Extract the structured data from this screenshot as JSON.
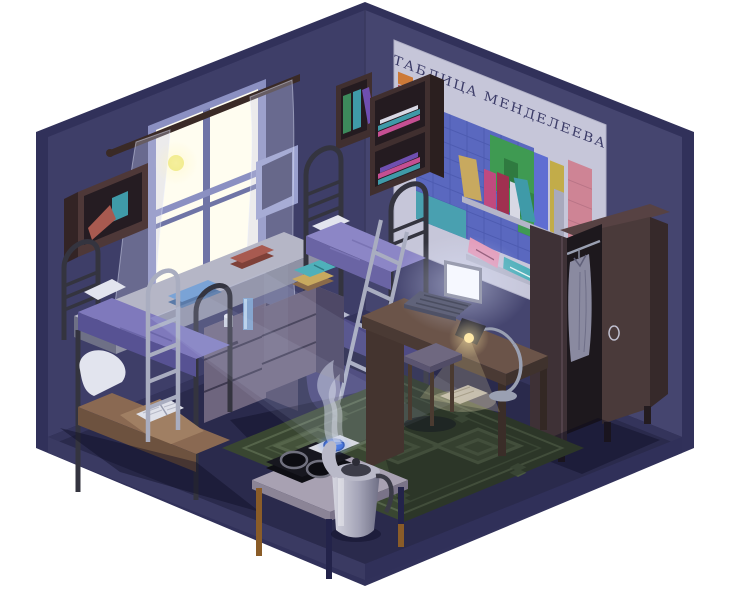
{
  "poster": {
    "title": "ТАБЛИЦА МЕНДЕЛЕЕВА"
  },
  "palette": {
    "bg": "#ffffff",
    "rimOuter": "#31315a",
    "wallLeft": "#3e3e68",
    "wallRight": "#45456f",
    "floor": "#2a2a4c",
    "floorRimL": "#3a3a62",
    "floorRimR": "#303059",
    "junction": "#3d3d68",
    "woodDark": "#402f2f",
    "woodDarker": "#2b1f1f",
    "woodTop": "#553d3b",
    "rodBrown": "#3a2a26",
    "metalDark": "#34343f",
    "metalLight": "#a9adc0",
    "winFrame": "#8b90c2",
    "winFrameDk": "#6f74a6",
    "pane": "#fffdf0",
    "moon": "#ece87a",
    "posterBg": "#c6c6d9",
    "posterInk": "#3c3c68",
    "cellBlue": "#5a68bf",
    "cellBlueLine": "#4a58ac",
    "cellGreen": "#3f9a52",
    "cellGreenDark": "#2f7a40",
    "cellYellow": "#c2ac49",
    "cellPink": "#ce8495",
    "cellRed": "#c05560",
    "cellOrange": "#cd7a38",
    "cellTeal": "#49a0b0",
    "shelfLight": "#b4b5c8",
    "blanketPurple": "#7f79bc",
    "blanketPurpleSide": "#575293",
    "blanketLit": "#8c86c6",
    "blanketLitSide": "#6a64a4",
    "blanketDim": "#4f4b85",
    "blanketDimSide": "#403c72",
    "blanketTan": "#8a6952",
    "blanketTanSide": "#6d523f",
    "pillow": "#e2e4ee",
    "nsFront": "#6e657e",
    "nsSide": "#4e4866",
    "nsTop": "#8c84a0",
    "benchTop": "#b5b6c6",
    "benchFront": "#8f91a4",
    "deskTop": "#6b5449",
    "deskFront": "#4a3a34",
    "deskSide": "#44342f",
    "laptopScreen": "#f6f8ff",
    "laptopFrame": "#9a9db0",
    "laptopBody": "#60637a",
    "lampMetal": "#9aa0b2",
    "lampShade": "#33333e",
    "rug": "#394631",
    "rugLine": "#55644a",
    "tableTop": "#a8a1b2",
    "tableEdge": "#8b8496",
    "legWood": "#8a5c28",
    "legDark": "#23234a",
    "stove": "#17171f",
    "burnerRing": "#70707e",
    "board": "#d8dae2",
    "burnerBlue": "#3a66cc",
    "kettleLight": "#d6d6e0",
    "kettleDark": "#6e6e84",
    "kettleLid": "#3c3c48",
    "wrFront": "#4a3a3a",
    "wrDoor": "#3e3136",
    "wrInterior": "#1d181d",
    "wrSide": "#36292a",
    "wrTop": "#574243",
    "shirt": "#8a8aa0",
    "bookTan": "#c8a95f",
    "bookMagenta": "#c04a7f",
    "bookCrimson": "#a03050",
    "bookWhite": "#d8d8e4",
    "bookTeal": "#3f9aa8",
    "bookGreen": "#3d8a5c",
    "bookPurple": "#6f4fb0",
    "bookPink": "#c54f92",
    "bookBlue": "#7aa3d6",
    "bookRed": "#a85a50",
    "paperPink": "#e49ab8",
    "notebookTeal": "#4fb0ba",
    "frameLav": "#9aa0cf",
    "frameInner": "#3b3b60",
    "stoolTop": "#6f6880",
    "curtain": "rgba(195,200,228,0.32)",
    "beam": "rgba(212,222,250,0.09)",
    "steam": "rgba(202,208,226,0.55)"
  },
  "objects": [
    "moonlit-window",
    "moon",
    "sheer-curtains",
    "curtain-rod",
    "picture-frame",
    "wall-shelf-left",
    "windowsill-bench",
    "bunk-bed-left",
    "bunk-bed-center",
    "bed-ladder",
    "nightstand",
    "nightstand-2",
    "wall-bookcase",
    "periodic-table-poster",
    "shelf-above-desk",
    "desk",
    "laptop",
    "desk-lamp",
    "stool",
    "wardrobe",
    "hanging-shirt",
    "rug",
    "kitchen-table",
    "electric-stove",
    "cutting-board-blue-burner",
    "kettle",
    "steam",
    "moonbeam"
  ]
}
